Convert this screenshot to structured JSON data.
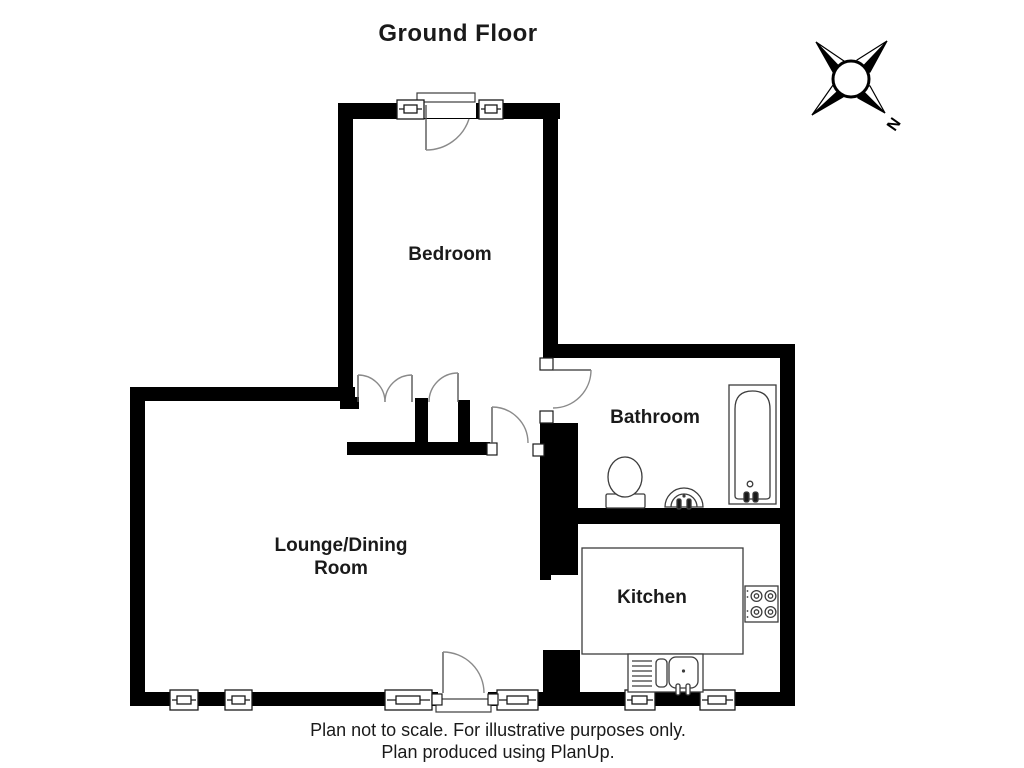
{
  "title": "Ground Floor",
  "compass": {
    "north_label": "N"
  },
  "rooms": {
    "bedroom": {
      "label": "Bedroom"
    },
    "bathroom": {
      "label": "Bathroom"
    },
    "kitchen": {
      "label": "Kitchen"
    },
    "lounge": {
      "label_line1": "Lounge/Dining",
      "label_line2": "Room"
    }
  },
  "fixtures": [
    "bathtub",
    "toilet",
    "wash-basin",
    "hob",
    "kitchen-sink",
    "counter",
    "wardrobe"
  ],
  "footer": {
    "line1": "Plan not to scale.  For illustrative purposes only.",
    "line2": "Plan produced using PlanUp."
  },
  "colors": {
    "wall": "#000000",
    "background": "#ffffff",
    "door_arc": "#8a8a8a",
    "fixture_line": "#3c3c3c",
    "text": "#1a1a1a"
  }
}
